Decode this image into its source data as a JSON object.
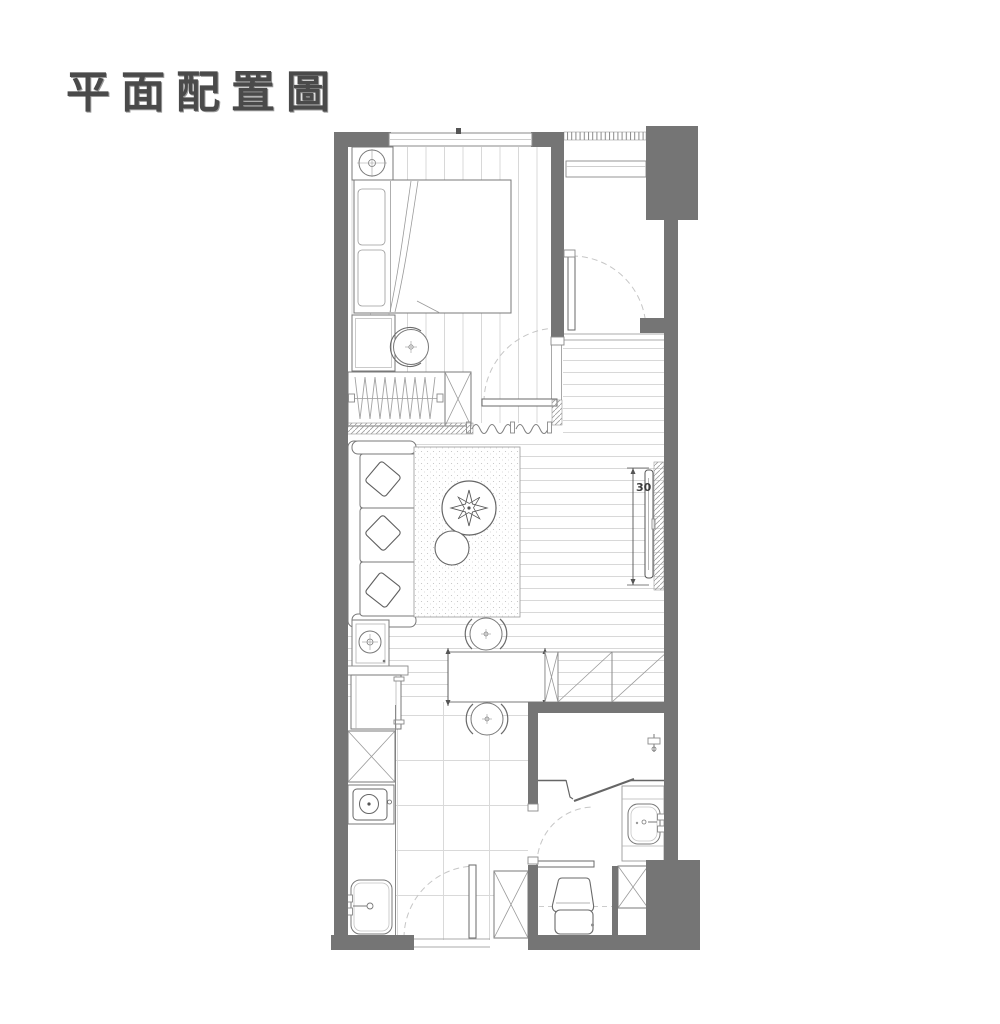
{
  "title": "平面配置圖",
  "floorplan": {
    "tv_depth_label": "30",
    "colors": {
      "wall": "#757575",
      "furniture_line": "#787878",
      "floor_line": "#d6d6d6",
      "door_arc": "#c6c6c6",
      "title": "#4a4a4a",
      "background": "#ffffff"
    },
    "symbols": [
      "window",
      "entry-door",
      "bedroom-door",
      "bathroom-door",
      "kitchen-door",
      "bed",
      "headboard-pillows",
      "nightstand-lamp",
      "nightstand",
      "swivel-stool",
      "wardrobe-hangers",
      "storage-box-x",
      "curtain",
      "sofa-3seat",
      "throw-pillows",
      "area-rug",
      "round-coffee-table",
      "plant",
      "round-side-table",
      "lamp-table",
      "tv-wall-mounted",
      "dining-table",
      "dining-chair",
      "sideboard-cabinets",
      "washer",
      "stove-cooktop",
      "kitchen-sink",
      "tall-cabinet-x",
      "shower-head",
      "shower-partition",
      "vanity-sink",
      "toilet",
      "shaft-x"
    ]
  }
}
